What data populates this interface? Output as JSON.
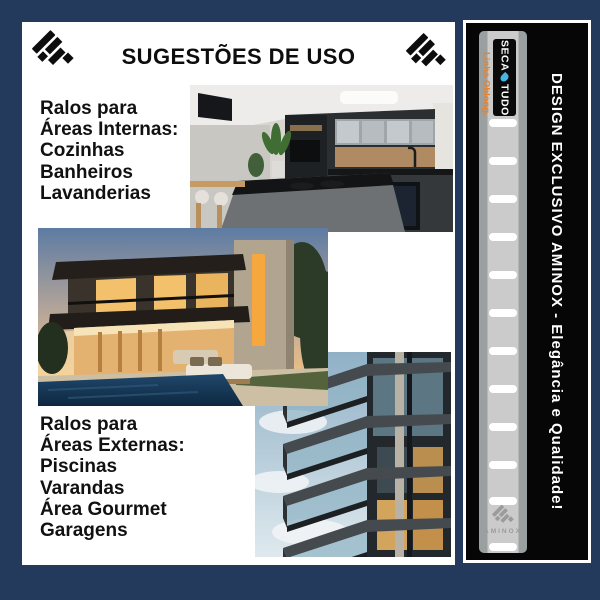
{
  "header": {
    "title": "SUGESTÕES DE USO"
  },
  "sections": {
    "internas": {
      "line1": "Ralos para",
      "line2": "Áreas Internas:",
      "items": [
        "Cozinhas",
        "Banheiros",
        "Lavanderias"
      ]
    },
    "externas": {
      "line1": "Ralos para",
      "line2": "Áreas Externas:",
      "items": [
        "Piscinas",
        "Varandas",
        "Área Gourmet",
        "Garagens"
      ]
    }
  },
  "photos": [
    {
      "alt": "Cozinha moderna com ilha preta e armários escuros"
    },
    {
      "alt": "Casa moderna com piscina ao entardecer"
    },
    {
      "alt": "Prédio residencial com varandas de vidro"
    }
  ],
  "side_panel": {
    "slogan": "DESIGN EXCLUSIVO AMINOX - Elegância e Qualidade!",
    "brand_prefix": "SECA",
    "brand_suffix": "TUDO",
    "product_line": "Linha Oblong.",
    "stamp_text": "AMINOX"
  },
  "colors": {
    "background_navy": "#233a5c",
    "card_white": "#ffffff",
    "panel_black": "#060606",
    "accent_orange": "#e8822f",
    "droplet_blue": "#45b4e6",
    "strip_gray": "#cbcbcb",
    "strip_edge_gray": "#9aa0a0",
    "text_black": "#111111"
  }
}
